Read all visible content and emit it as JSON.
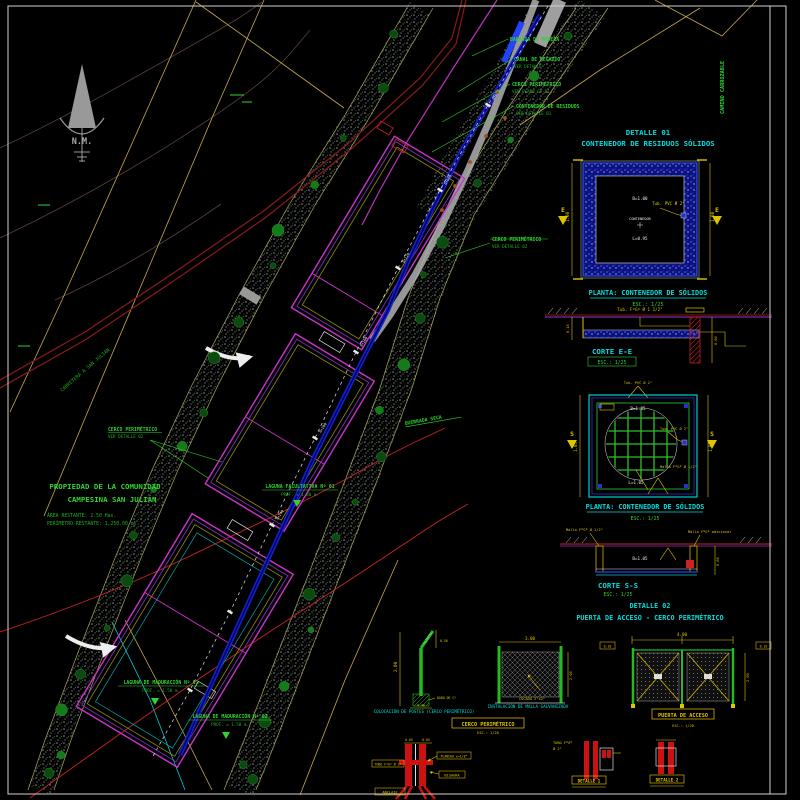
{
  "colors": {
    "cyan": "#00dede",
    "green": "#2fd42f",
    "green2": "#1fae1f",
    "yellow": "#e0c400",
    "magenta": "#cc33cc",
    "blue": "#2233cc",
    "red": "#cc2222",
    "white": "#e8e8e8",
    "gray_road": "#b0b0b0",
    "dark_red_road": "#8b1a1a",
    "tan": "#c8a84b",
    "purple": "#8833cc"
  },
  "plan": {
    "north_label": "N.M.",
    "property": {
      "line1": "PROPIEDAD DE LA COMUNIDAD",
      "line2": "CAMPESINA SAN JULIÁN",
      "sub1": "ÁREA RESTANTE: 2.50 Has.",
      "sub2": "PERÍMETRO RESTANTE: 1,250.00 ml."
    },
    "labels": {
      "baranda": "BARANDA DE MADERA",
      "canal_l1": "CANAL DE REGADÍO",
      "canal_l2": "VER DETALLE",
      "cerco_top_l1": "CERCO PERIMÉTRICO",
      "cerco_top_l2": "VER PLANO CP-01",
      "contenedor_l1": "CONTENEDOR DE RESIDUOS",
      "contenedor_l2": "VER DETALLE 01",
      "cerco_mid_l1": "CERCO PERIMÉTRICO",
      "cerco_mid_l2": "VER DETALLE 02",
      "cerco_left_l1": "CERCO PERIMÉTRICO",
      "cerco_left_l2": "VER DETALLE 02",
      "quebrada": "QUEBRADA SECA",
      "carretera": "CARRETERA A SAN JULIÁN",
      "camino_vertical": "CAMINO CARROZABLE",
      "laguna1_l1": "LAGUNA FACULTATIVA Nº 01",
      "laguna1_l2": "PROF. = 1.80 m.",
      "laguna2_l1": "LAGUNA DE MADURACIÓN Nº 01",
      "laguna2_l2": "PROF. = 1.50 m.",
      "laguna3_l1": "LAGUNA DE MADURACIÓN Nº 02",
      "laguna3_l2": "PROF. = 1.50 m."
    },
    "stations": [
      "0+040",
      "0+080",
      "0+120",
      "0+160",
      "0+200",
      "0+240"
    ]
  },
  "details": {
    "d1": {
      "title1": "DETALLE 01",
      "title2": "CONTENEDOR DE RESIDUOS SÓLIDOS",
      "marker": "E",
      "dim_left": "1.00",
      "dim_right": "1.00",
      "txt1": "B=1.00",
      "txt2": "CONTENEDOR",
      "txt3": "L=0.95",
      "pipe": "Tub. PVC Ø 2\"",
      "caption": "PLANTA: CONTENEDOR DE SÓLIDOS",
      "scale": "ESC.: 1/25"
    },
    "d2": {
      "caption": "CORTE E-E",
      "scale": "ESC.: 1/25",
      "pipe": "Tub. FºGº Ø 1 1/2\"",
      "dim1": "0.60",
      "dim2": "0.15"
    },
    "d3": {
      "marker": "S",
      "txt_top": "B=1.05",
      "txt_bot": "L=1.05",
      "grid": "Malla FºGº Ø 1/2\"",
      "pipe": "Tub. PVC Ø 2\"",
      "dim_left": "1.05",
      "dim_top": "1.05",
      "caption": "PLANTA: CONTENEDOR DE SÓLIDOS",
      "scale": "ESC.: 1/25"
    },
    "d4": {
      "caption": "CORTE S-S",
      "scale": "ESC.: 1/25",
      "call1": "Malla FºGº Ø 1/2\"",
      "call2": "Malla FºGº adicional",
      "txt": "B=1.05",
      "dim": "0.60"
    },
    "d5": {
      "title1": "DETALLE 02",
      "title2": "PUERTA DE ACCESO - CERCO PERIMÉTRICO"
    },
    "post": {
      "caption": "COLOCACIÓN DE POSTES (CERCO PERIMÉTRICO)",
      "dim_h": "2.00",
      "dim_top": "0.50",
      "base": "DADO DE Cº",
      "dim_base": "0.40"
    },
    "mesh": {
      "caption": "INSTALACIÓN DE MALLA GALVANIZADA",
      "dim_w": "3.00",
      "dim_h": "2.00",
      "note": "COCADA 2\"x2\""
    },
    "cerco_box": {
      "label": "CERCO PERIMÉTRICO",
      "scale": "ESC.: 1/20"
    },
    "gate": {
      "dim_top": "4.00",
      "dim_right": "2.00",
      "tag_left": "0.10",
      "tag_right": "0.10",
      "label": "PUERTA DE ACCESO",
      "scale": "ESC.: 1/20"
    },
    "hinge": {
      "dim1": "0.05",
      "dim2": "0.05",
      "call_left": "TUBO FºGº Ø 2\"",
      "call_r1": "PLANCHA e=1/8\"",
      "call_r2": "BISAGRA",
      "call_bottom": "ANCLAJE"
    },
    "det1": {
      "label": "DETALLE 1",
      "c1": "TUBO FºGº",
      "c2": "Ø 2\""
    },
    "det2": {
      "label": "DETALLE 2"
    }
  }
}
